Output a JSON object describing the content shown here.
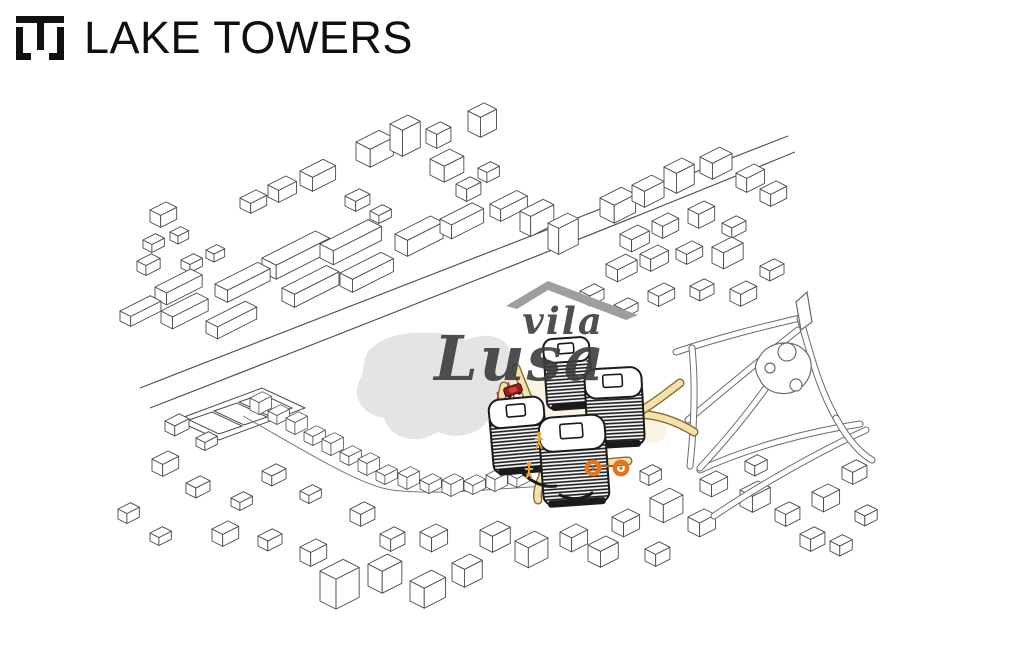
{
  "header": {
    "title": "LAKE TOWERS",
    "logo_name": "lake-towers-monogram-icon"
  },
  "watermark": {
    "line1": "vila",
    "line2": "Lusa",
    "roof_icon": "roof-swoosh-icon"
  },
  "colors": {
    "ink": "#4a4a4a",
    "tower_ink": "#1b1b1b",
    "lake": "#e4e4e4",
    "path_fill": "#f3e2ae",
    "path_edge": "#8a6b2f",
    "red_line": "#b5342a",
    "car": "#9e1b14",
    "bike": "#e2761c",
    "person": "#e3a93c",
    "park_line": "#6b6b6b",
    "watermark_text": "#3c3c3c",
    "roof_gray": "#9e9e9e"
  },
  "map": {
    "roads": [
      "M140,388 C320,318 540,232 788,136",
      "M150,408 C330,338 550,252 795,152"
    ],
    "street": "M243,416 C300,448 360,486 392,490 C440,496 500,488 548,486",
    "lake": "M368,352 C382,332 430,326 466,340 C498,328 516,344 508,364 C522,380 514,402 492,410 C488,432 460,442 438,432 C416,446 390,438 384,418 C360,414 350,394 362,376 C364,366 364,358 368,352 Z",
    "courts": {
      "outer": "176,420 262,388 305,408 219,440",
      "inner": [
        "189,420 212,412 242,426 219,434",
        "214,411 237,403 267,417 244,425",
        "239,402 262,394 292,408 269,416"
      ]
    },
    "buildings": [
      [
        356,
        160,
        26,
        16,
        18
      ],
      [
        390,
        150,
        20,
        14,
        26
      ],
      [
        426,
        143,
        16,
        12,
        14
      ],
      [
        468,
        131,
        18,
        14,
        20
      ],
      [
        430,
        175,
        22,
        16,
        16
      ],
      [
        456,
        196,
        16,
        12,
        12
      ],
      [
        478,
        178,
        14,
        10,
        10
      ],
      [
        300,
        185,
        26,
        14,
        14
      ],
      [
        268,
        197,
        20,
        12,
        12
      ],
      [
        240,
        208,
        18,
        12,
        10
      ],
      [
        345,
        206,
        16,
        12,
        10
      ],
      [
        370,
        219,
        14,
        10,
        8
      ],
      [
        150,
        222,
        18,
        12,
        12
      ],
      [
        143,
        248,
        14,
        10,
        8
      ],
      [
        170,
        240,
        12,
        9,
        8
      ],
      [
        137,
        271,
        16,
        10,
        10
      ],
      [
        181,
        268,
        14,
        10,
        8
      ],
      [
        206,
        258,
        12,
        9,
        8
      ],
      [
        262,
        272,
        60,
        16,
        14
      ],
      [
        320,
        258,
        54,
        15,
        14
      ],
      [
        215,
        296,
        48,
        14,
        12
      ],
      [
        155,
        299,
        40,
        13,
        12
      ],
      [
        120,
        321,
        34,
        12,
        10
      ],
      [
        161,
        323,
        40,
        13,
        12
      ],
      [
        206,
        333,
        44,
        13,
        12
      ],
      [
        282,
        301,
        50,
        14,
        13
      ],
      [
        340,
        286,
        46,
        14,
        13
      ],
      [
        395,
        250,
        40,
        14,
        16
      ],
      [
        440,
        233,
        36,
        13,
        14
      ],
      [
        490,
        216,
        30,
        12,
        12
      ],
      [
        520,
        231,
        26,
        12,
        20
      ],
      [
        548,
        249,
        22,
        12,
        26
      ],
      [
        600,
        216,
        24,
        16,
        18
      ],
      [
        632,
        201,
        22,
        14,
        16
      ],
      [
        664,
        187,
        20,
        14,
        20
      ],
      [
        700,
        173,
        22,
        14,
        16
      ],
      [
        736,
        187,
        20,
        12,
        14
      ],
      [
        760,
        201,
        18,
        12,
        12
      ],
      [
        620,
        246,
        20,
        13,
        12
      ],
      [
        652,
        233,
        18,
        12,
        12
      ],
      [
        688,
        223,
        18,
        12,
        14
      ],
      [
        722,
        233,
        16,
        11,
        10
      ],
      [
        606,
        276,
        22,
        13,
        12
      ],
      [
        640,
        266,
        20,
        12,
        12
      ],
      [
        676,
        259,
        18,
        12,
        10
      ],
      [
        712,
        263,
        22,
        13,
        16
      ],
      [
        648,
        301,
        18,
        12,
        10
      ],
      [
        690,
        296,
        16,
        11,
        10
      ],
      [
        730,
        301,
        18,
        12,
        12
      ],
      [
        760,
        276,
        16,
        11,
        10
      ],
      [
        614,
        313,
        16,
        11,
        8
      ],
      [
        580,
        301,
        16,
        11,
        10
      ],
      [
        165,
        431,
        16,
        11,
        10
      ],
      [
        196,
        446,
        14,
        10,
        8
      ],
      [
        152,
        471,
        18,
        12,
        12
      ],
      [
        186,
        493,
        16,
        11,
        10
      ],
      [
        231,
        506,
        14,
        10,
        8
      ],
      [
        262,
        481,
        16,
        11,
        10
      ],
      [
        300,
        499,
        14,
        10,
        8
      ],
      [
        212,
        541,
        18,
        12,
        12
      ],
      [
        258,
        546,
        16,
        11,
        10
      ],
      [
        300,
        561,
        18,
        12,
        14
      ],
      [
        150,
        541,
        14,
        10,
        8
      ],
      [
        118,
        519,
        14,
        10,
        10
      ],
      [
        320,
        601,
        26,
        18,
        30
      ],
      [
        368,
        586,
        22,
        16,
        22
      ],
      [
        410,
        601,
        24,
        16,
        20
      ],
      [
        452,
        581,
        20,
        14,
        18
      ],
      [
        420,
        546,
        18,
        13,
        14
      ],
      [
        380,
        546,
        16,
        12,
        12
      ],
      [
        350,
        521,
        16,
        12,
        12
      ],
      [
        480,
        546,
        20,
        14,
        16
      ],
      [
        515,
        561,
        22,
        15,
        20
      ],
      [
        560,
        546,
        18,
        13,
        14
      ],
      [
        588,
        561,
        20,
        14,
        16
      ],
      [
        612,
        531,
        18,
        13,
        14
      ],
      [
        650,
        516,
        22,
        15,
        18
      ],
      [
        688,
        531,
        18,
        13,
        14
      ],
      [
        645,
        561,
        16,
        12,
        12
      ],
      [
        700,
        491,
        18,
        13,
        12
      ],
      [
        740,
        506,
        20,
        14,
        16
      ],
      [
        775,
        521,
        16,
        12,
        12
      ],
      [
        812,
        506,
        18,
        13,
        14
      ],
      [
        842,
        479,
        16,
        12,
        12
      ],
      [
        855,
        521,
        14,
        11,
        10
      ],
      [
        745,
        471,
        14,
        11,
        10
      ],
      [
        640,
        481,
        14,
        10,
        10
      ],
      [
        800,
        546,
        16,
        12,
        12
      ],
      [
        830,
        551,
        14,
        11,
        10
      ]
    ],
    "chain": [
      [
        250,
        410
      ],
      [
        268,
        420
      ],
      [
        286,
        430
      ],
      [
        304,
        441
      ],
      [
        322,
        451
      ],
      [
        340,
        461
      ],
      [
        358,
        471
      ],
      [
        376,
        480
      ],
      [
        398,
        485
      ],
      [
        420,
        489
      ],
      [
        442,
        492
      ],
      [
        464,
        490
      ],
      [
        486,
        487
      ],
      [
        508,
        483
      ],
      [
        530,
        479
      ]
    ],
    "park": {
      "corridors": [
        "M676,352 C724,336 766,326 800,318",
        "M688,420 C724,390 762,358 798,330",
        "M700,470 C748,448 806,432 860,424",
        "M714,516 C758,486 818,452 866,430",
        "M800,318 C810,352 818,386 836,418",
        "M692,348 C696,388 694,428 690,466",
        "M836,418 C846,436 858,452 872,460",
        "M700,468 C726,440 760,400 790,352"
      ],
      "pond": "M760,356 C768,342 792,338 804,350 C816,360 812,380 800,388 C788,398 766,394 760,380 C754,370 754,364 760,356 Z",
      "trees": [
        [
          787,
          352,
          9
        ],
        [
          796,
          385,
          6
        ],
        [
          770,
          368,
          5
        ]
      ],
      "flag": "796,302 807,292 812,322 801,330"
    },
    "plaza": {
      "ground": "M500,380 C540,372 600,380 650,408 C670,420 672,436 656,444 C620,436 600,450 586,492 C570,500 550,492 540,470 C520,440 504,410 500,380 Z",
      "yellow": [
        "M516,368 C528,398 540,430 556,458 C566,472 576,486 584,500",
        "M540,432 C570,426 602,416 634,414 C658,414 678,422 694,432",
        "M504,386 C497,414 496,440 508,464",
        "M560,468 C586,466 606,462 628,461",
        "M636,414 C656,402 668,392 680,383",
        "M545,470 C540,482 536,492 538,500"
      ],
      "red": [
        "M508,382 C520,412 532,442 548,468",
        "M497,392 C505,420 509,444 520,466"
      ],
      "canopies": [
        "M520,470 C530,482 544,488 556,486",
        "M560,495 C572,501 584,499 592,493"
      ]
    },
    "towers": [
      {
        "x": 545,
        "y": 338,
        "w": 46,
        "h": 70,
        "rot": -4
      },
      {
        "x": 586,
        "y": 368,
        "w": 57,
        "h": 78,
        "rot": -3
      },
      {
        "x": 491,
        "y": 398,
        "w": 55,
        "h": 74,
        "rot": -5
      },
      {
        "x": 541,
        "y": 416,
        "w": 66,
        "h": 88,
        "rot": -4
      }
    ],
    "icons": {
      "car": {
        "name": "car-icon",
        "x": 513,
        "y": 390,
        "rot": -18
      },
      "bicycle": {
        "name": "bicycle-icon",
        "x": 593,
        "y": 468,
        "gap": 28
      },
      "persons": {
        "name": "pedestrian-icon",
        "pts": [
          [
            539,
            442
          ],
          [
            529,
            472
          ]
        ]
      }
    }
  }
}
